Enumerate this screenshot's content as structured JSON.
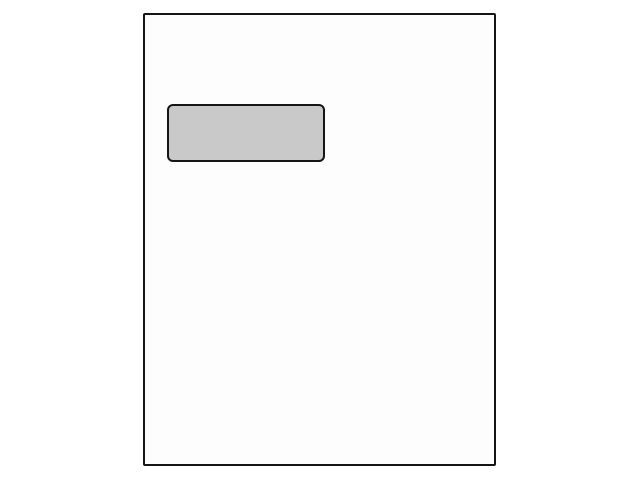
{
  "illustration": {
    "description": "window-envelope-sheet-diagram",
    "text_content": ""
  },
  "colors": {
    "canvas-bg": "#ffffff",
    "sheet-fill": "#fdfdfd",
    "sheet-border": "#151515",
    "window-fill": "#c9c9c9",
    "window-border": "#151515"
  }
}
